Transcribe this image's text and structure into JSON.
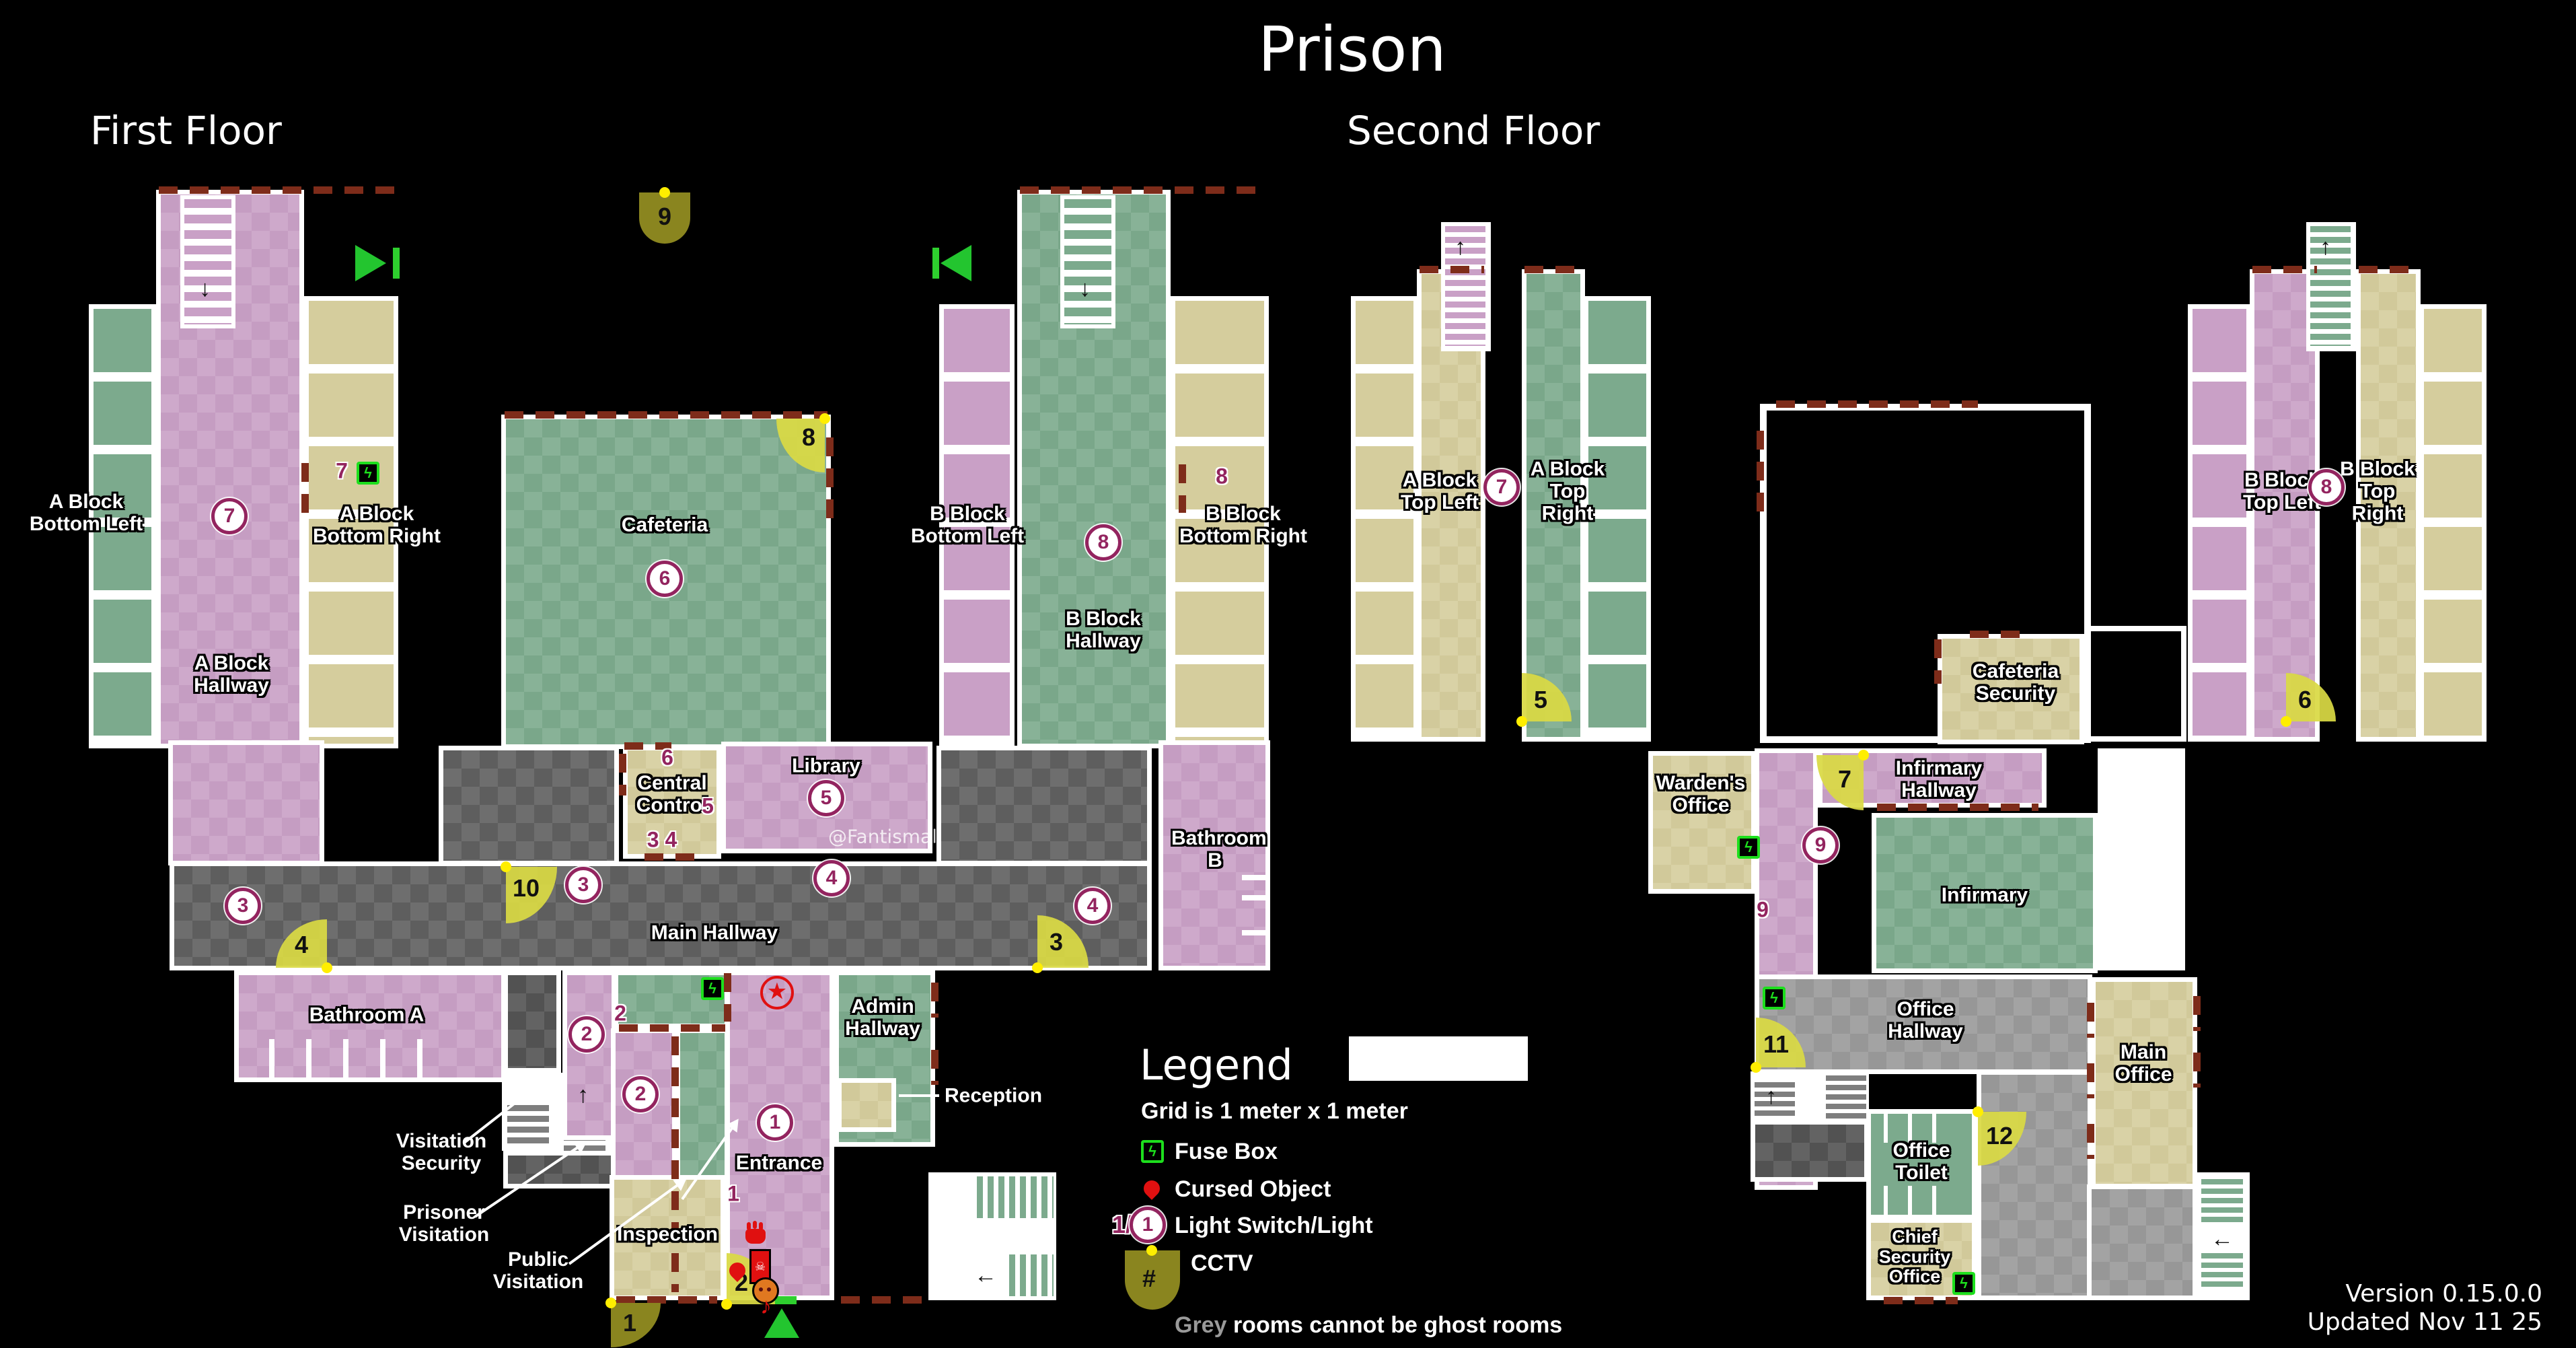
{
  "title": "Prison",
  "floor_first": "First Floor",
  "floor_second": "Second Floor",
  "watermark": "@Fantismal",
  "version_line1": "Version 0.15.0.0",
  "version_line2": "Updated Nov 11 25",
  "legend": {
    "heading": "Legend",
    "grid_note": "Grid is 1 meter x 1 meter",
    "fuse_label": "Fuse Box",
    "cursed_label": "Cursed Object",
    "light_label": "Light Switch/Light",
    "light_switch_sample": "1/",
    "light_sample": "1",
    "cctv_label": "CCTV",
    "cctv_symbol": "#",
    "grey_word": "Grey",
    "grey_note_rest": " rooms cannot be ghost rooms"
  },
  "rooms": {
    "a_block_bottom_left": "A Block Bottom Left",
    "a_block_bottom_right": "A Block Bottom Right",
    "a_block_hallway": "A Block Hallway",
    "cafeteria": "Cafeteria",
    "b_block_bottom_left": "B Block Bottom Left",
    "b_block_bottom_right": "B Block Bottom Right",
    "b_block_hallway": "B Block Hallway",
    "central_control": "Central Control",
    "library": "Library",
    "main_hallway": "Main Hallway",
    "bathroom_a": "Bathroom A",
    "bathroom_b": "Bathroom B",
    "visitation_security": "Visitation Security",
    "prisoner_visitation": "Prisoner Visitation",
    "public_visitation": "Public Visitation",
    "inspection": "Inspection",
    "entrance": "Entrance",
    "admin_hallway": "Admin Hallway",
    "reception": "Reception",
    "a_block_top_left": "A Block Top Left",
    "a_block_top_right": "A Block Top Right",
    "b_block_top_left": "B Block Top Left",
    "b_block_top_right": "B Block Top Right",
    "wardens_office": "Warden's Office",
    "cafeteria_security": "Cafeteria Security",
    "infirmary_hallway": "Infirmary Hallway",
    "infirmary": "Infirmary",
    "office_hallway": "Office Hallway",
    "office_toilet": "Office Toilet",
    "main_office": "Main Office",
    "chief_security_office": "Chief Security Office"
  },
  "lights_first": [
    "7",
    "6",
    "8",
    "5",
    "3",
    "3",
    "4",
    "4",
    "2",
    "2",
    "1"
  ],
  "lights_second": [
    "7",
    "8",
    "9"
  ],
  "switches_first": [
    "7",
    "8",
    "6",
    "5",
    "3 4",
    "2",
    "1"
  ],
  "switches_second": [
    "9"
  ],
  "cameras": [
    "1",
    "2",
    "3",
    "4",
    "5",
    "6",
    "7",
    "8",
    "9",
    "10",
    "11",
    "12"
  ],
  "icons": {
    "up_arrow": "↑",
    "down_arrow": "↓",
    "left_arrow": "←",
    "lightning": "ϟ",
    "skull": "☠",
    "music_note": "♪",
    "star": "★",
    "hash": "#"
  },
  "colors": {
    "background": "#000000",
    "wall": "#ffffff",
    "pink_room": "#c9a0c6",
    "green_room": "#7caa8d",
    "tan_room": "#d5cd9d",
    "main_hallway_gray": "#606060",
    "office_hallway_gray": "#9a9a9a",
    "red_dash_wall": "#7e2c1a",
    "camera_yellow": "#d9d944",
    "camera_olive": "#8a851f",
    "light_magenta": "#93245f",
    "fuse_green": "#1ddf1d",
    "cursed_red": "#e01010",
    "exit_green": "#23c52f"
  }
}
